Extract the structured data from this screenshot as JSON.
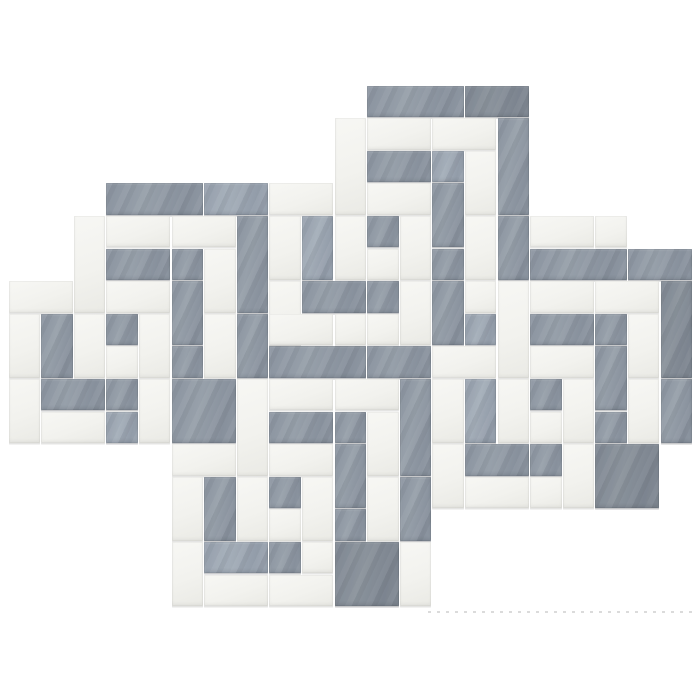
{
  "image": {
    "kind": "product-photo",
    "subject": "marble mosaic tile sheet",
    "pattern": "interlocking greek-key square spirals",
    "materials": "gray bardiglio and white thassos marble strips",
    "background_color": "#ffffff"
  },
  "palette": {
    "gray": "#8b94a0",
    "gray_light": "#9aa2ae",
    "gray_dark": "#7e8793",
    "white_marble": "#f2f2ee",
    "white_shade": "#e9e9e4",
    "seam": "#ffffff",
    "edge_shadow": "#55575c"
  },
  "grid": {
    "origin_x": 8,
    "origin_y": 85,
    "unit": 32.6,
    "cols": 21,
    "rows": 16,
    "seam_gap": 1.2
  },
  "artifact_line": {
    "x1": 428,
    "x2": 698,
    "y": 611
  },
  "pieces": [
    [
      11,
      0,
      3,
      1,
      "g",
      0
    ],
    [
      14,
      0,
      2,
      1,
      "g",
      2
    ],
    [
      15,
      1,
      1,
      3,
      "g",
      0
    ],
    [
      15,
      4,
      1,
      2,
      "g",
      0
    ],
    [
      11,
      1,
      2,
      1,
      "w",
      0
    ],
    [
      13,
      1,
      2,
      1,
      "w",
      0
    ],
    [
      14,
      2,
      1,
      2,
      "w",
      0
    ],
    [
      14,
      4,
      1,
      2,
      "w",
      0
    ],
    [
      11,
      2,
      2,
      1,
      "g",
      0
    ],
    [
      13,
      2,
      1,
      1,
      "g",
      1
    ],
    [
      13,
      3,
      1,
      2,
      "g",
      0
    ],
    [
      13,
      5,
      1,
      1,
      "g",
      0
    ],
    [
      11,
      3,
      2,
      1,
      "w",
      0
    ],
    [
      12,
      4,
      1,
      2,
      "w",
      0
    ],
    [
      11,
      4,
      1,
      1,
      "g",
      0
    ],
    [
      11,
      5,
      1,
      1,
      "w",
      0
    ],
    [
      13,
      6,
      1,
      2,
      "g",
      0
    ],
    [
      10,
      1,
      1,
      3,
      "w",
      0
    ],
    [
      10,
      4,
      1,
      2,
      "w",
      0
    ],
    [
      8,
      3,
      2,
      1,
      "w",
      0
    ],
    [
      9,
      4,
      1,
      2,
      "g",
      1
    ],
    [
      8,
      4,
      1,
      2,
      "w",
      0
    ],
    [
      8,
      6,
      1,
      2,
      "w",
      0
    ],
    [
      9,
      6,
      2,
      1,
      "g",
      0
    ],
    [
      11,
      6,
      1,
      1,
      "g",
      0
    ],
    [
      12,
      6,
      1,
      2,
      "w",
      0
    ],
    [
      11,
      7,
      1,
      1,
      "w",
      0
    ],
    [
      14,
      6,
      1,
      1,
      "w",
      0
    ],
    [
      14,
      7,
      1,
      1,
      "g",
      1
    ],
    [
      3,
      3,
      3,
      1,
      "g",
      0
    ],
    [
      6,
      3,
      2,
      1,
      "g",
      1
    ],
    [
      7,
      4,
      1,
      3,
      "g",
      0
    ],
    [
      7,
      7,
      1,
      2,
      "g",
      0
    ],
    [
      3,
      4,
      2,
      1,
      "w",
      0
    ],
    [
      5,
      4,
      2,
      1,
      "w",
      0
    ],
    [
      6,
      5,
      1,
      2,
      "w",
      0
    ],
    [
      6,
      7,
      1,
      2,
      "w",
      0
    ],
    [
      3,
      5,
      2,
      1,
      "g",
      0
    ],
    [
      5,
      5,
      1,
      1,
      "g",
      0
    ],
    [
      5,
      6,
      1,
      2,
      "g",
      0
    ],
    [
      5,
      8,
      1,
      1,
      "g",
      0
    ],
    [
      3,
      6,
      2,
      1,
      "w",
      0
    ],
    [
      4,
      7,
      1,
      2,
      "w",
      0
    ],
    [
      3,
      7,
      1,
      1,
      "g",
      0
    ],
    [
      3,
      8,
      1,
      1,
      "w",
      0
    ],
    [
      2,
      4,
      1,
      3,
      "w",
      0
    ],
    [
      2,
      7,
      1,
      2,
      "w",
      0
    ],
    [
      0,
      6,
      2,
      1,
      "w",
      0
    ],
    [
      1,
      7,
      1,
      2,
      "g",
      0
    ],
    [
      0,
      7,
      1,
      2,
      "w",
      0
    ],
    [
      0,
      9,
      1,
      2,
      "w",
      0
    ],
    [
      1,
      9,
      2,
      1,
      "g",
      0
    ],
    [
      3,
      9,
      1,
      1,
      "g",
      0
    ],
    [
      4,
      9,
      1,
      2,
      "w",
      0
    ],
    [
      3,
      10,
      1,
      1,
      "g",
      1
    ],
    [
      1,
      10,
      2,
      1,
      "w",
      0
    ],
    [
      5,
      9,
      2,
      2,
      "g",
      0
    ],
    [
      16,
      5,
      3,
      1,
      "g",
      0
    ],
    [
      19,
      5,
      2,
      1,
      "g",
      0
    ],
    [
      20,
      6,
      1,
      3,
      "g",
      2
    ],
    [
      20,
      9,
      1,
      2,
      "g",
      0
    ],
    [
      16,
      6,
      2,
      1,
      "w",
      0
    ],
    [
      18,
      6,
      2,
      1,
      "w",
      0
    ],
    [
      19,
      7,
      1,
      2,
      "w",
      0
    ],
    [
      19,
      9,
      1,
      2,
      "w",
      0
    ],
    [
      16,
      7,
      2,
      1,
      "g",
      0
    ],
    [
      18,
      7,
      1,
      1,
      "g",
      0
    ],
    [
      18,
      8,
      1,
      2,
      "g",
      0
    ],
    [
      18,
      10,
      1,
      1,
      "g",
      0
    ],
    [
      16,
      8,
      2,
      1,
      "w",
      0
    ],
    [
      17,
      9,
      1,
      2,
      "w",
      0
    ],
    [
      16,
      9,
      1,
      1,
      "g",
      0
    ],
    [
      16,
      10,
      1,
      1,
      "w",
      0
    ],
    [
      15,
      6,
      1,
      3,
      "w",
      0
    ],
    [
      15,
      9,
      1,
      2,
      "w",
      0
    ],
    [
      16,
      4,
      2,
      1,
      "w",
      0
    ],
    [
      18,
      4,
      1,
      1,
      "w",
      0
    ],
    [
      13,
      8,
      2,
      1,
      "w",
      0
    ],
    [
      14,
      9,
      1,
      2,
      "g",
      1
    ],
    [
      13,
      9,
      1,
      2,
      "w",
      0
    ],
    [
      13,
      11,
      1,
      2,
      "w",
      0
    ],
    [
      14,
      11,
      2,
      1,
      "g",
      0
    ],
    [
      16,
      11,
      1,
      1,
      "g",
      0
    ],
    [
      17,
      11,
      1,
      2,
      "w",
      0
    ],
    [
      16,
      12,
      1,
      1,
      "w",
      0
    ],
    [
      14,
      12,
      2,
      1,
      "w",
      0
    ],
    [
      18,
      11,
      2,
      2,
      "g",
      2
    ],
    [
      8,
      8,
      3,
      1,
      "g",
      0
    ],
    [
      11,
      8,
      2,
      1,
      "g",
      0
    ],
    [
      12,
      9,
      1,
      3,
      "g",
      0
    ],
    [
      12,
      12,
      1,
      2,
      "g",
      0
    ],
    [
      8,
      9,
      2,
      1,
      "w",
      0
    ],
    [
      10,
      9,
      2,
      1,
      "w",
      0
    ],
    [
      11,
      10,
      1,
      2,
      "w",
      0
    ],
    [
      11,
      12,
      1,
      2,
      "w",
      0
    ],
    [
      8,
      10,
      2,
      1,
      "g",
      0
    ],
    [
      10,
      10,
      1,
      1,
      "g",
      0
    ],
    [
      10,
      11,
      1,
      2,
      "g",
      0
    ],
    [
      10,
      13,
      1,
      1,
      "g",
      0
    ],
    [
      8,
      11,
      2,
      1,
      "w",
      0
    ],
    [
      9,
      12,
      1,
      2,
      "w",
      0
    ],
    [
      8,
      12,
      1,
      1,
      "g",
      0
    ],
    [
      8,
      13,
      1,
      1,
      "w",
      0
    ],
    [
      7,
      9,
      1,
      3,
      "w",
      0
    ],
    [
      7,
      12,
      1,
      2,
      "w",
      0
    ],
    [
      8,
      7,
      2,
      1,
      "w",
      0
    ],
    [
      10,
      7,
      1,
      1,
      "w",
      0
    ],
    [
      5,
      11,
      2,
      1,
      "w",
      0
    ],
    [
      6,
      12,
      1,
      2,
      "g",
      0
    ],
    [
      5,
      12,
      1,
      2,
      "w",
      0
    ],
    [
      5,
      14,
      1,
      2,
      "w",
      0
    ],
    [
      6,
      14,
      2,
      1,
      "g",
      1
    ],
    [
      8,
      14,
      1,
      1,
      "g",
      0
    ],
    [
      9,
      14,
      1,
      1,
      "w",
      0
    ],
    [
      8,
      15,
      2,
      1,
      "w",
      0
    ],
    [
      6,
      15,
      2,
      1,
      "w",
      0
    ],
    [
      12,
      14,
      1,
      2,
      "w",
      0
    ],
    [
      10,
      14,
      2,
      2,
      "g",
      2
    ]
  ]
}
